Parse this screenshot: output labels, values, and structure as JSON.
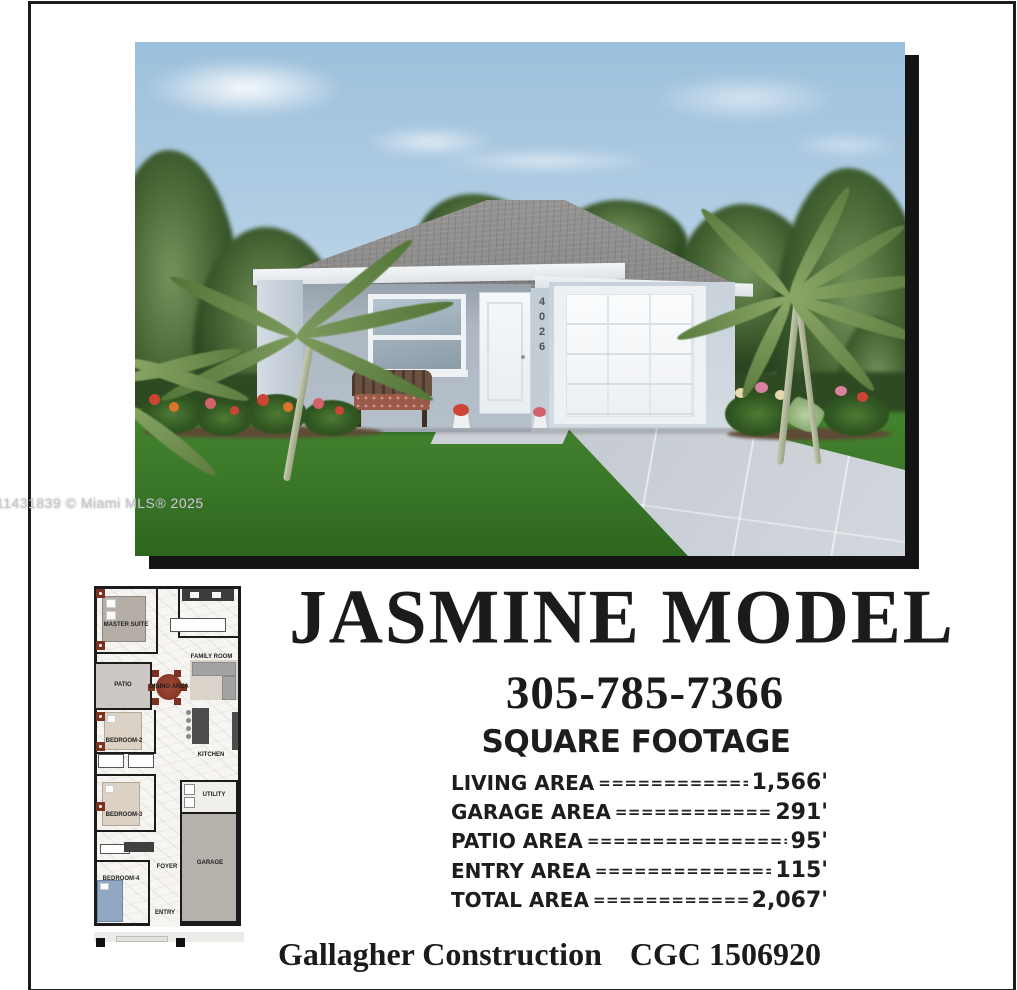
{
  "page": {
    "watermark": "11431839 © Miami MLS® 2025"
  },
  "title": "JASMINE MODEL",
  "phone": "305-785-7366",
  "photo": {
    "house_number": "4026"
  },
  "sqft": {
    "heading": "SQUARE FOOTAGE",
    "leader": "================================================",
    "rows": [
      {
        "label": "LIVING AREA",
        "value": "1,566'"
      },
      {
        "label": "GARAGE AREA",
        "value": "291'"
      },
      {
        "label": "PATIO AREA",
        "value": "95'"
      },
      {
        "label": "ENTRY AREA",
        "value": "115'"
      },
      {
        "label": "TOTAL AREA",
        "value": "2,067'"
      }
    ]
  },
  "footer": {
    "company": "Gallagher Construction",
    "license": "CGC 1506920"
  },
  "floorplan": {
    "rooms": {
      "master": "MASTER SUITE",
      "family": "FAMILY ROOM",
      "patio": "PATIO",
      "dining": "DINING AREA",
      "bedroom2": "BEDROOM-2",
      "kitchen": "KITCHEN",
      "bedroom3": "BEDROOM-3",
      "utility": "UTILITY",
      "foyer": "FOYER",
      "garage": "GARAGE",
      "bedroom4": "BEDROOM-4",
      "entry": "ENTRY"
    }
  },
  "colors": {
    "frame": "#1c1c1c",
    "sky": "#aecbe2",
    "grass": "#3c7a2a",
    "roof": "#8d8b89",
    "wall": "#c9d2da",
    "driveway": "#c9ced5",
    "shadow": "#141414",
    "text": "#1b1b1b"
  }
}
